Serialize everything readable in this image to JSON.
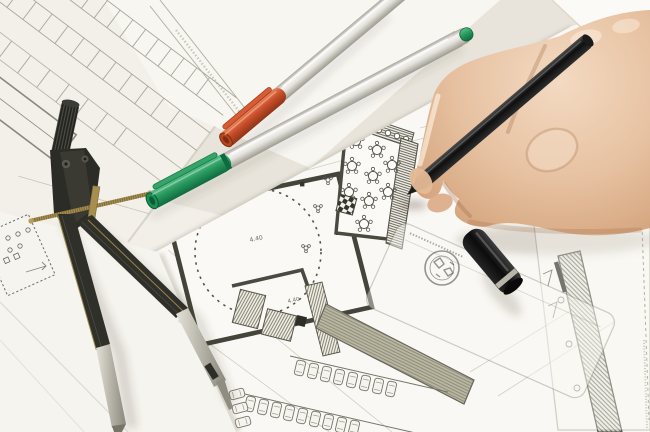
{
  "plan_labels": {
    "dim1": "4.40",
    "dim2": "4.40",
    "dim3": "3750",
    "dim4": "390"
  },
  "colors": {
    "background": "#e8e4db",
    "paper": "#f7f5f0",
    "plan_wall": "#45453b",
    "plan_line": "#8f8c7e",
    "orange_cap": "#c94f2a",
    "orange_cap_light": "#e8835c",
    "green_cap": "#2a9a5f",
    "green_cap_light": "#5fbd8c",
    "pen_barrel": "#dcdad2",
    "black_pen": "#161616",
    "pen_cap_ring": "#b8b4a9",
    "skin": "#e7c2a2",
    "skin_shadow": "#bd8a64",
    "brass": "#a58e4e",
    "metal": "#cfccc2"
  }
}
